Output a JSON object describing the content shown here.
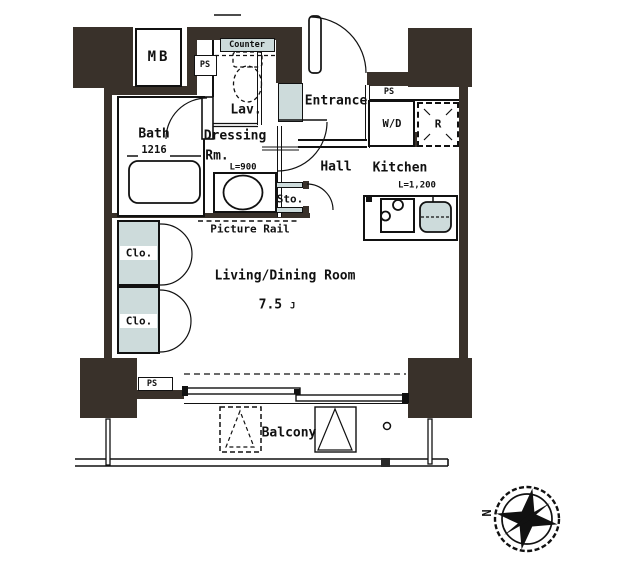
{
  "floor_plan": {
    "labels": {
      "mb": "MB",
      "ps_left": "PS",
      "ps_right": "PS",
      "ps_bottom": "PS",
      "counter": "Counter",
      "lav": "Lav.",
      "bath": "Bath",
      "bath_size": "1216",
      "dressing_line1": "Dressing",
      "dressing_line2": "Rm.",
      "dressing_counter_length": "L=900",
      "entrance": "Entrance",
      "washer_dryer": "W/D",
      "refrigerator": "R",
      "hall": "Hall",
      "kitchen": "Kitchen",
      "kitchen_counter_length": "L=1,200",
      "storage": "Sto.",
      "picture_rail": "Picture Rail",
      "closet_upper": "Clo.",
      "closet_lower": "Clo.",
      "living_dining": "Living/Dining Room",
      "living_size_value": "7.5",
      "living_size_unit": "J",
      "balcony": "Balcony"
    },
    "compass": {
      "north": "N"
    },
    "colors": {
      "wall": "#39312a",
      "fixture_fill": "#cddbdb",
      "line": "#111111",
      "background": "#ffffff"
    }
  }
}
